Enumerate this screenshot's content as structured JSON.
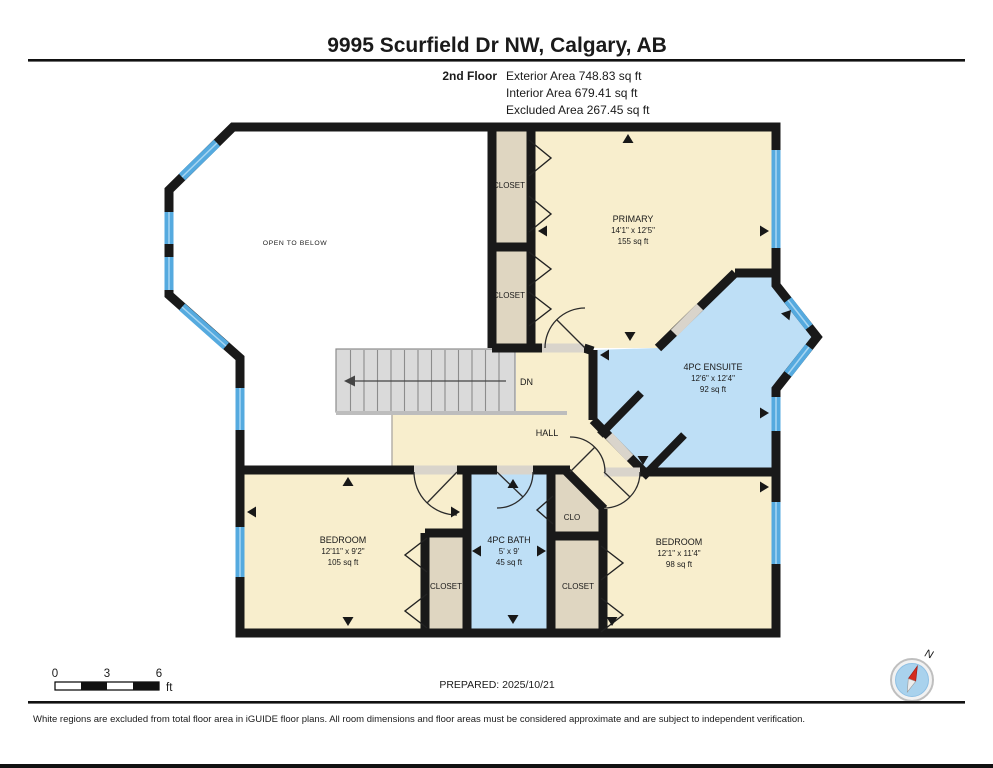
{
  "header": {
    "title": "9995 Scurfield Dr NW, Calgary, AB"
  },
  "floor": {
    "label": "2nd Floor",
    "stats": [
      "Exterior Area 748.83 sq ft",
      "Interior Area 679.41 sq ft",
      "Excluded Area 267.45 sq ft"
    ]
  },
  "rooms": {
    "open_below": {
      "name": "OPEN TO BELOW"
    },
    "closet_top": {
      "name": "CLOSET"
    },
    "closet_mid": {
      "name": "CLOSET"
    },
    "primary": {
      "name": "PRIMARY",
      "dims": "14'1\" x 12'5\"",
      "area": "155 sq ft"
    },
    "ensuite": {
      "name": "4PC ENSUITE",
      "dims": "12'6\" x 12'4\"",
      "area": "92 sq ft"
    },
    "stairs": {
      "label": "DN"
    },
    "hall": {
      "name": "HALL"
    },
    "bedroom_left": {
      "name": "BEDROOM",
      "dims": "12'11\" x 9'2\"",
      "area": "105 sq ft"
    },
    "bath": {
      "name": "4PC BATH",
      "dims": "5' x 9'",
      "area": "45 sq ft"
    },
    "clo": {
      "name": "CLO"
    },
    "closet_bottom_left": {
      "name": "CLOSET"
    },
    "closet_bottom_right": {
      "name": "CLOSET"
    },
    "bedroom_right": {
      "name": "BEDROOM",
      "dims": "12'1\" x 11'4\"",
      "area": "98 sq ft"
    }
  },
  "scale_bar": {
    "ticks": [
      "0",
      "3",
      "6"
    ],
    "unit": "ft"
  },
  "footer": {
    "prepared": "PREPARED: 2025/10/21",
    "disclaimer": "White regions are excluded from total floor area in iGUIDE floor plans. All room dimensions and floor areas must be considered approximate and are subject to independent verification."
  },
  "compass": {
    "label": "N"
  },
  "colors": {
    "room_cream": "#F8EECD",
    "room_blue": "#BEDFF6",
    "closet_tan": "#DFD6C1",
    "window_blue": "#55AADF",
    "window_stripe": "#A8D6F2",
    "wall": "#191919",
    "stairs": "#DADADA",
    "stairs_line": "#8C8C8C",
    "opening_gray": "#D9D4CB",
    "compass_blue": "#A9D2ED",
    "needle_red": "#D42B1E"
  }
}
